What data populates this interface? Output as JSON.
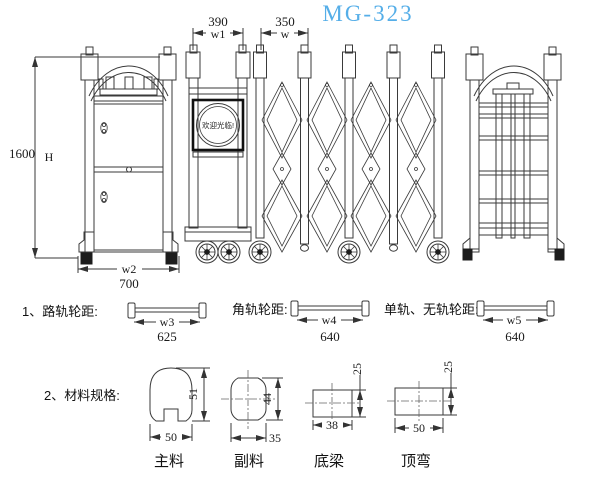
{
  "title": "MG-323",
  "colors": {
    "title": "#55AEE8",
    "line": "#3a3a3a"
  },
  "front_view": {
    "height": "1600",
    "height_var": "H",
    "width_var": "w2",
    "width": "700"
  },
  "gate_view": {
    "head_width": "390",
    "head_width_var": "w1",
    "bay_width": "350",
    "bay_width_var": "w",
    "sign": "欢迎光临!"
  },
  "wheel_spacing": {
    "heading": "1、路轨轮距:",
    "items": [
      {
        "label": "",
        "var": "w3",
        "value": "625"
      },
      {
        "label": "角轨轮距:",
        "var": "w4",
        "value": "640"
      },
      {
        "label": "单轨、无轨轮距:",
        "var": "w5",
        "value": "640"
      }
    ]
  },
  "materials": {
    "heading": "2、材料规格:",
    "items": [
      {
        "name": "主料",
        "width": "50",
        "height": "51"
      },
      {
        "name": "副料",
        "width": "35",
        "height": "44"
      },
      {
        "name": "底梁",
        "width": "38",
        "height": "25"
      },
      {
        "name": "顶弯",
        "width": "50",
        "height": "25"
      }
    ]
  }
}
